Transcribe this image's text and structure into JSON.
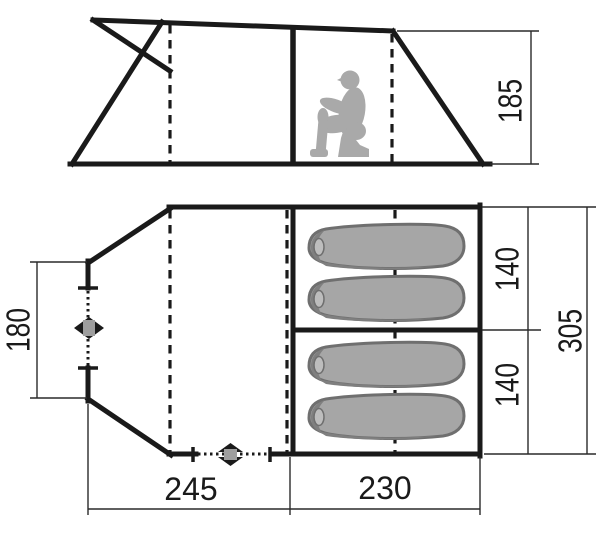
{
  "diagram": {
    "type": "tent-dimension-diagram",
    "views": {
      "side_elevation": "tent side view with crouching person silhouette",
      "floor_plan": "tent floor plan with four sleeping bags in two cabins"
    },
    "dims": {
      "height": "185",
      "rear_width": "180",
      "cabin_depth_front": "140",
      "cabin_depth_rear": "140",
      "total_depth": "305",
      "porch_length": "245",
      "cabin_length": "230"
    },
    "icons": {
      "left_entrance_toggle": "diamond-zip-toggle",
      "front_entrance_toggle": "diamond-zip-toggle"
    },
    "colors": {
      "line": "#1a1a1a",
      "silhouette_gray": "#a9a9a9",
      "bag_fill": "#a6a6a6",
      "bag_outline": "#6f6f6f",
      "hood_shade": "#7f7f7f",
      "toggle_center": "#9e9e9e",
      "background": "#ffffff"
    }
  }
}
